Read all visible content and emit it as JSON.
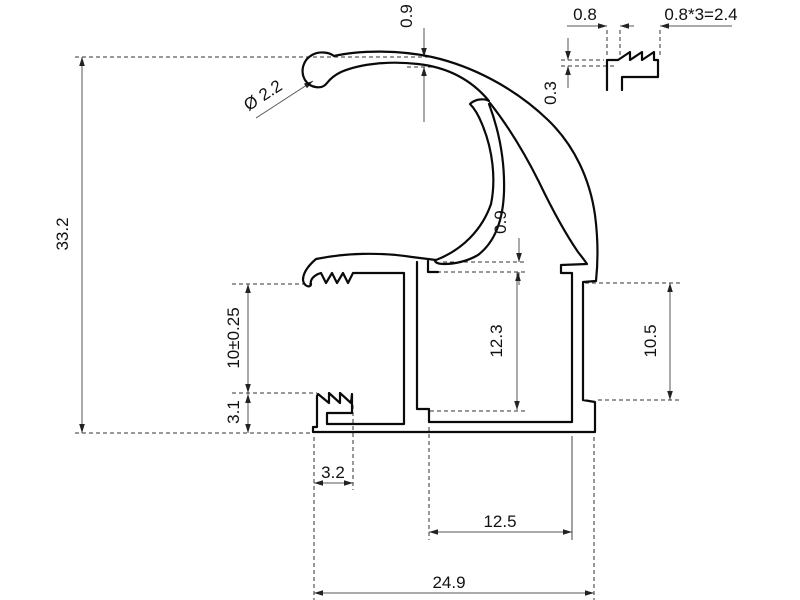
{
  "drawing": {
    "type": "technical-profile-cross-section",
    "dims": {
      "top_wall_thickness": "0.9",
      "overall_height": "33.2",
      "tip_diameter": "Ø 2.2",
      "inner_wall_gap": "0.9",
      "middle_cavity_height": "12.3",
      "right_recess_height": "10.5",
      "clip_opening_height": "10±0.25",
      "hook_height": "3.1",
      "hook_width": "3.2",
      "middle_cavity_width": "12.5",
      "overall_width": "24.9"
    },
    "detail": {
      "tooth_pitch": "0.8",
      "teeth_span": "0.8*3=2.4",
      "tooth_depth": "0.3"
    },
    "colors": {
      "outline": "#0a0a0a",
      "dimension": "#555555",
      "background": "#ffffff"
    }
  }
}
